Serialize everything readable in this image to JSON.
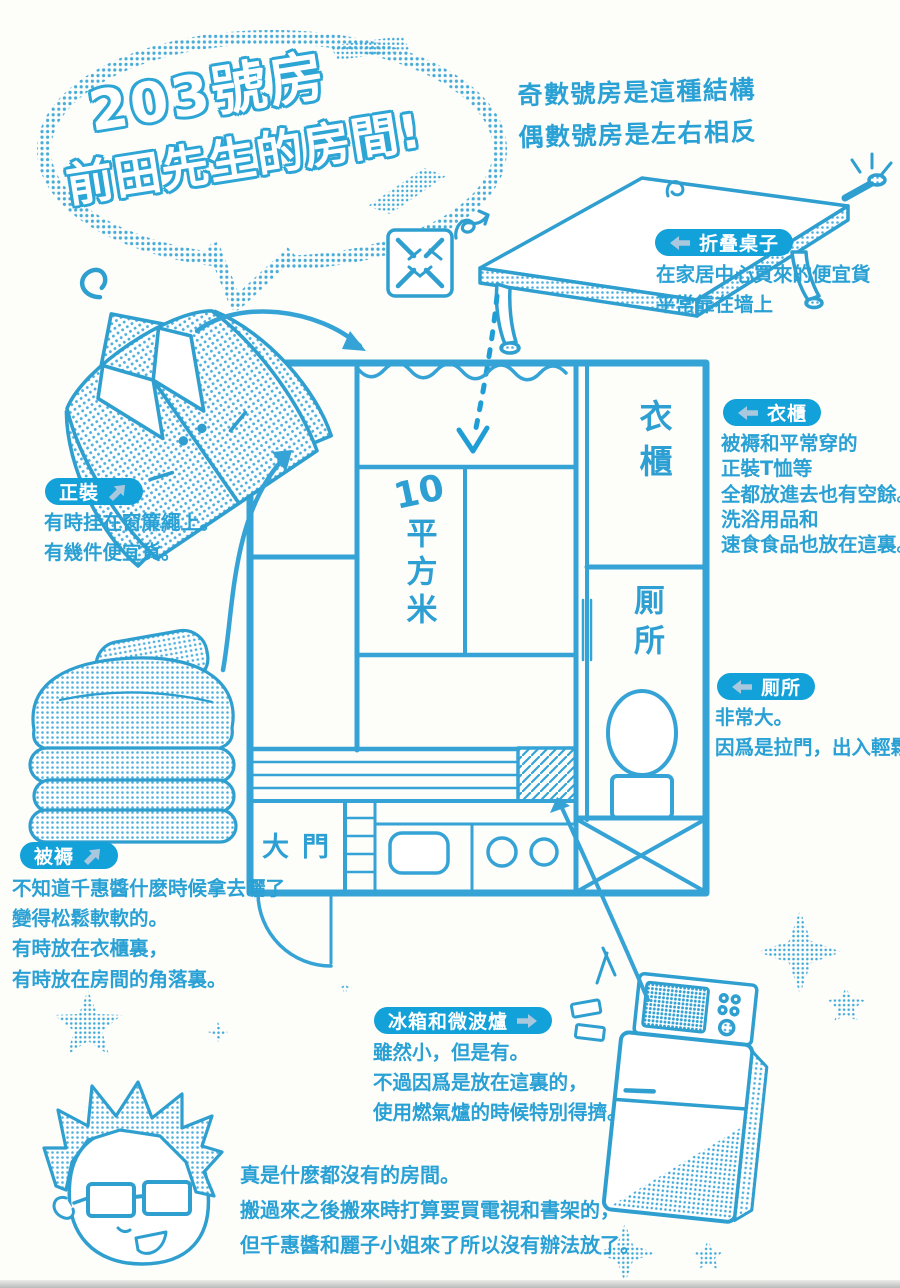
{
  "title": {
    "line1": "203號房",
    "line2": "前田先生的房間!"
  },
  "note_top_right": {
    "line1": "奇數號房是這種結構",
    "line2": "偶數號房是左右相反"
  },
  "floorplan": {
    "area_value": "10",
    "area_unit": "平方米",
    "closet": "衣櫃",
    "toilet": "厠所",
    "entrance": "大門"
  },
  "annotations": {
    "table": {
      "label": "折叠桌子",
      "arrow": "left",
      "lines": [
        "在家居中心買來的便宜貨",
        "平常靠在墙上"
      ]
    },
    "suit": {
      "label": "正裝",
      "arrow": "up-right",
      "lines": [
        "有時挂在窗簾繩上。",
        "有幾件便宜貨。"
      ]
    },
    "closet": {
      "label": "衣櫃",
      "arrow": "left",
      "lines": [
        "被褥和平常穿的",
        "正裝T恤等",
        "全都放進去也有空餘。",
        "洗浴用品和",
        "速食食品也放在這裏。"
      ]
    },
    "toilet": {
      "label": "厠所",
      "arrow": "left",
      "lines": [
        "非常大。",
        "因爲是拉門，出入輕鬆。"
      ]
    },
    "futon": {
      "label": "被褥",
      "arrow": "up-right",
      "lines": [
        "不知道千惠醬什麽時候拿去曬了",
        "變得松鬆軟軟的。",
        "有時放在衣櫃裏，",
        "有時放在房間的角落裏。"
      ]
    },
    "fridge": {
      "label": "冰箱和微波爐",
      "arrow": "right",
      "lines": [
        "雖然小，但是有。",
        "不過因爲是放在這裏的，",
        "使用燃氣爐的時候特別得擠。"
      ]
    }
  },
  "footer_note": {
    "lines": [
      "真是什麽都沒有的房間。",
      "搬過來之後搬來時打算要買電視和書架的，",
      "但千惠醬和麗子小姐來了所以沒有辦法放了。"
    ]
  },
  "colors": {
    "ink": "#2fa3d5",
    "label_bg": "#12a1d8",
    "label_arrow": "#a9c8de",
    "title_outline": "#2da5d5",
    "background": "#fdfdfa"
  }
}
